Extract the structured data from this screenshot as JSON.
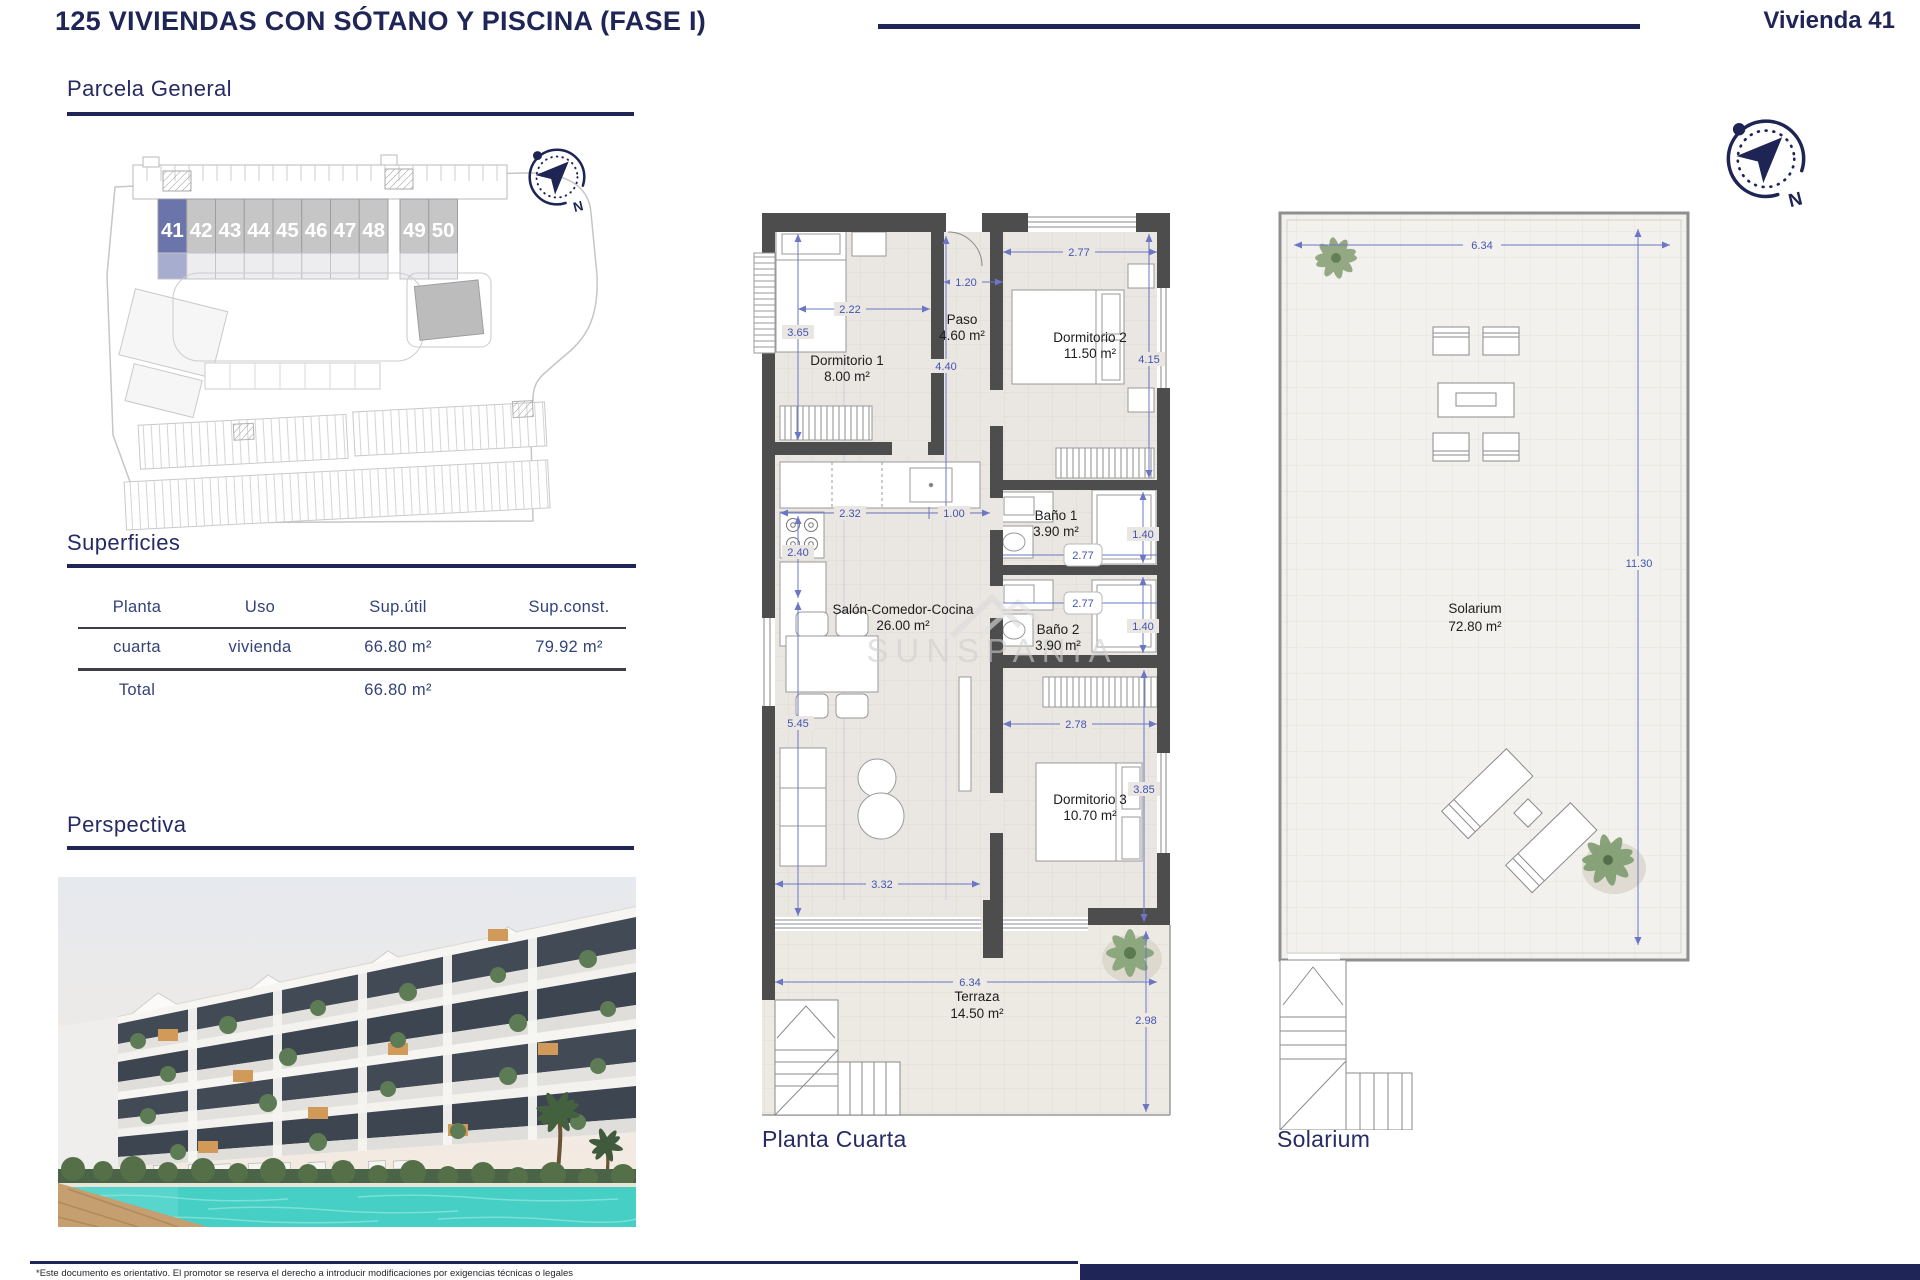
{
  "header": {
    "title": "125 VIVIENDAS CON SÓTANO Y PISCINA (FASE I)",
    "unit": "Vivienda 41"
  },
  "sections": {
    "parcela": "Parcela General",
    "superficies": "Superficies",
    "perspectiva": "Perspectiva"
  },
  "site_plan": {
    "units": [
      "41",
      "42",
      "43",
      "44",
      "45",
      "46",
      "47",
      "48",
      "49",
      "50"
    ],
    "highlighted_unit": "41"
  },
  "surfaces_table": {
    "headers": [
      "Planta",
      "Uso",
      "Sup.útil",
      "Sup.const."
    ],
    "rows": [
      {
        "planta": "cuarta",
        "uso": "vivienda",
        "sup_util": "66.80 m²",
        "sup_const": "79.92 m²"
      }
    ],
    "total": {
      "label": "Total",
      "sup_util": "66.80 m²",
      "sup_const": "79.92 m²"
    }
  },
  "floor_plan": {
    "caption": "Planta Cuarta",
    "rooms": [
      {
        "name": "Dormitorio 1",
        "area": "8.00 m²"
      },
      {
        "name": "Paso",
        "area": "4.60 m²"
      },
      {
        "name": "Dormitorio 2",
        "area": "11.50 m²"
      },
      {
        "name": "Baño 1",
        "area": "3.90 m²"
      },
      {
        "name": "Baño 2",
        "area": "3.90 m²"
      },
      {
        "name": "Salón-Comedor-Cocina",
        "area": "26.00 m²"
      },
      {
        "name": "Dormitorio 3",
        "area": "10.70 m²"
      },
      {
        "name": "Terraza",
        "area": "14.50 m²"
      }
    ],
    "dimensions": [
      "2.22",
      "3.65",
      "1.20",
      "4.40",
      "2.77",
      "4.15",
      "2.32",
      "1.00",
      "2.40",
      "1.40",
      "2.77",
      "2.77",
      "1.40",
      "5.45",
      "2.78",
      "3.85",
      "3.32",
      "6.34",
      "2.98"
    ]
  },
  "solarium_plan": {
    "caption": "Solarium",
    "room": {
      "name": "Solarium",
      "area": "72.80 m²"
    },
    "dimensions": [
      "6.34",
      "11.30"
    ]
  },
  "compass": {
    "north": "N"
  },
  "watermark": "SUNSPANIA",
  "footer": {
    "disclaimer": "*Este documento es orientativo. El promotor se reserva el derecho a introducir modificaciones por exigencias técnicas o legales"
  },
  "colors": {
    "navy": "#1f2557",
    "wall": "#4d4d4d",
    "floor": "#eae6e1",
    "dim_blue": "#4353b4",
    "highlight": "#6b75ac"
  }
}
